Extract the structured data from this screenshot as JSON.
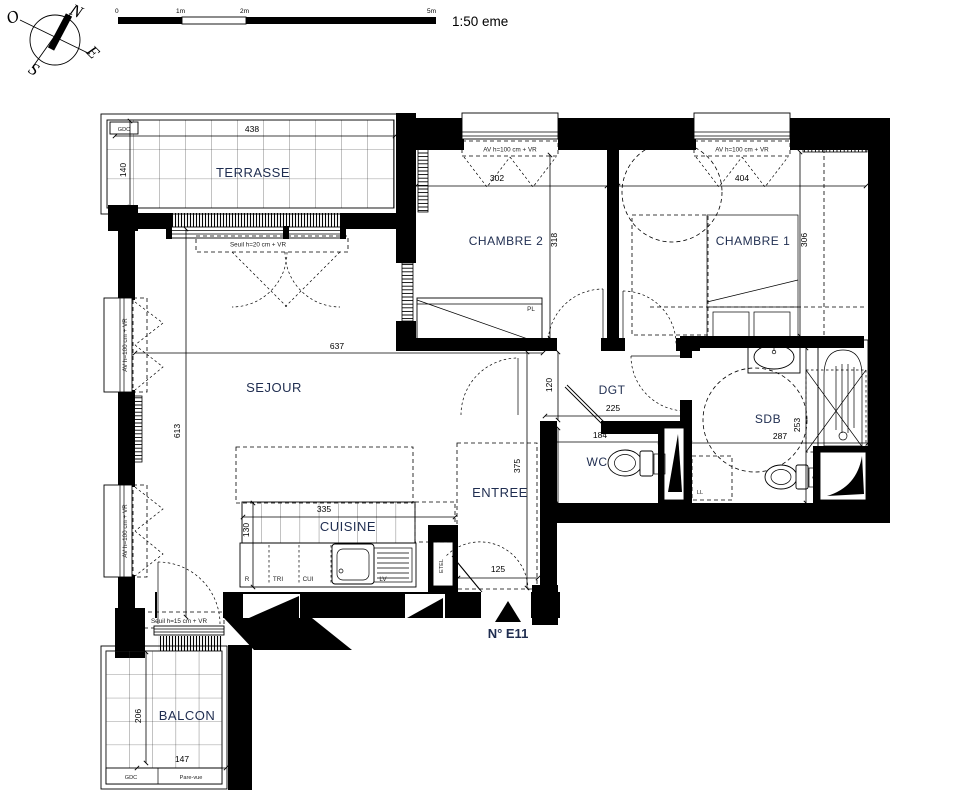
{
  "colors": {
    "ink": "#000000",
    "room_label": "#1f2d50",
    "annotation": "#222222",
    "pare_vue": "#7a3b2e"
  },
  "scalebar": {
    "ticks": [
      "0",
      "1m",
      "2m",
      "5m"
    ],
    "scale_text": "1:50 eme"
  },
  "compass": {
    "n": "N",
    "e": "E",
    "s": "S",
    "o": "O"
  },
  "rooms": {
    "terrasse": {
      "name": "TERRASSE",
      "w": "438",
      "h": "140"
    },
    "chambre2": {
      "name": "CHAMBRE 2",
      "w": "302",
      "h": "318"
    },
    "chambre1": {
      "name": "CHAMBRE 1",
      "w": "404",
      "h": "306"
    },
    "sejour": {
      "name": "SEJOUR",
      "w": "637",
      "h": "613"
    },
    "dgt": {
      "name": "DGT",
      "w": "225",
      "h": "120"
    },
    "wc": {
      "name": "WC",
      "w": "184",
      "h": "117"
    },
    "sdb": {
      "name": "SDB",
      "w": "287",
      "h": "253"
    },
    "entree": {
      "name": "ENTREE",
      "w": "125",
      "h": "375"
    },
    "cuisine": {
      "name": "CUISINE",
      "w": "335",
      "h": "130"
    },
    "balcon": {
      "name": "BALCON",
      "w": "147",
      "h": "206"
    }
  },
  "labels": {
    "av_window": "AV h=100 cm + VR",
    "seuil_terrasse": "Seuil h=20 cm + VR",
    "seuil_balcon": "Seuil h=15 cm + VR",
    "gdc": "GDC",
    "pare_vue": "Pare-vue",
    "placard": "PL",
    "lave_linge": "LL",
    "etel": "ETEL",
    "refrigerateur": "R",
    "tri": "TRI",
    "cuisson": "CUI",
    "lave_vaisselle": "LV",
    "unit_number": "N° E11"
  }
}
